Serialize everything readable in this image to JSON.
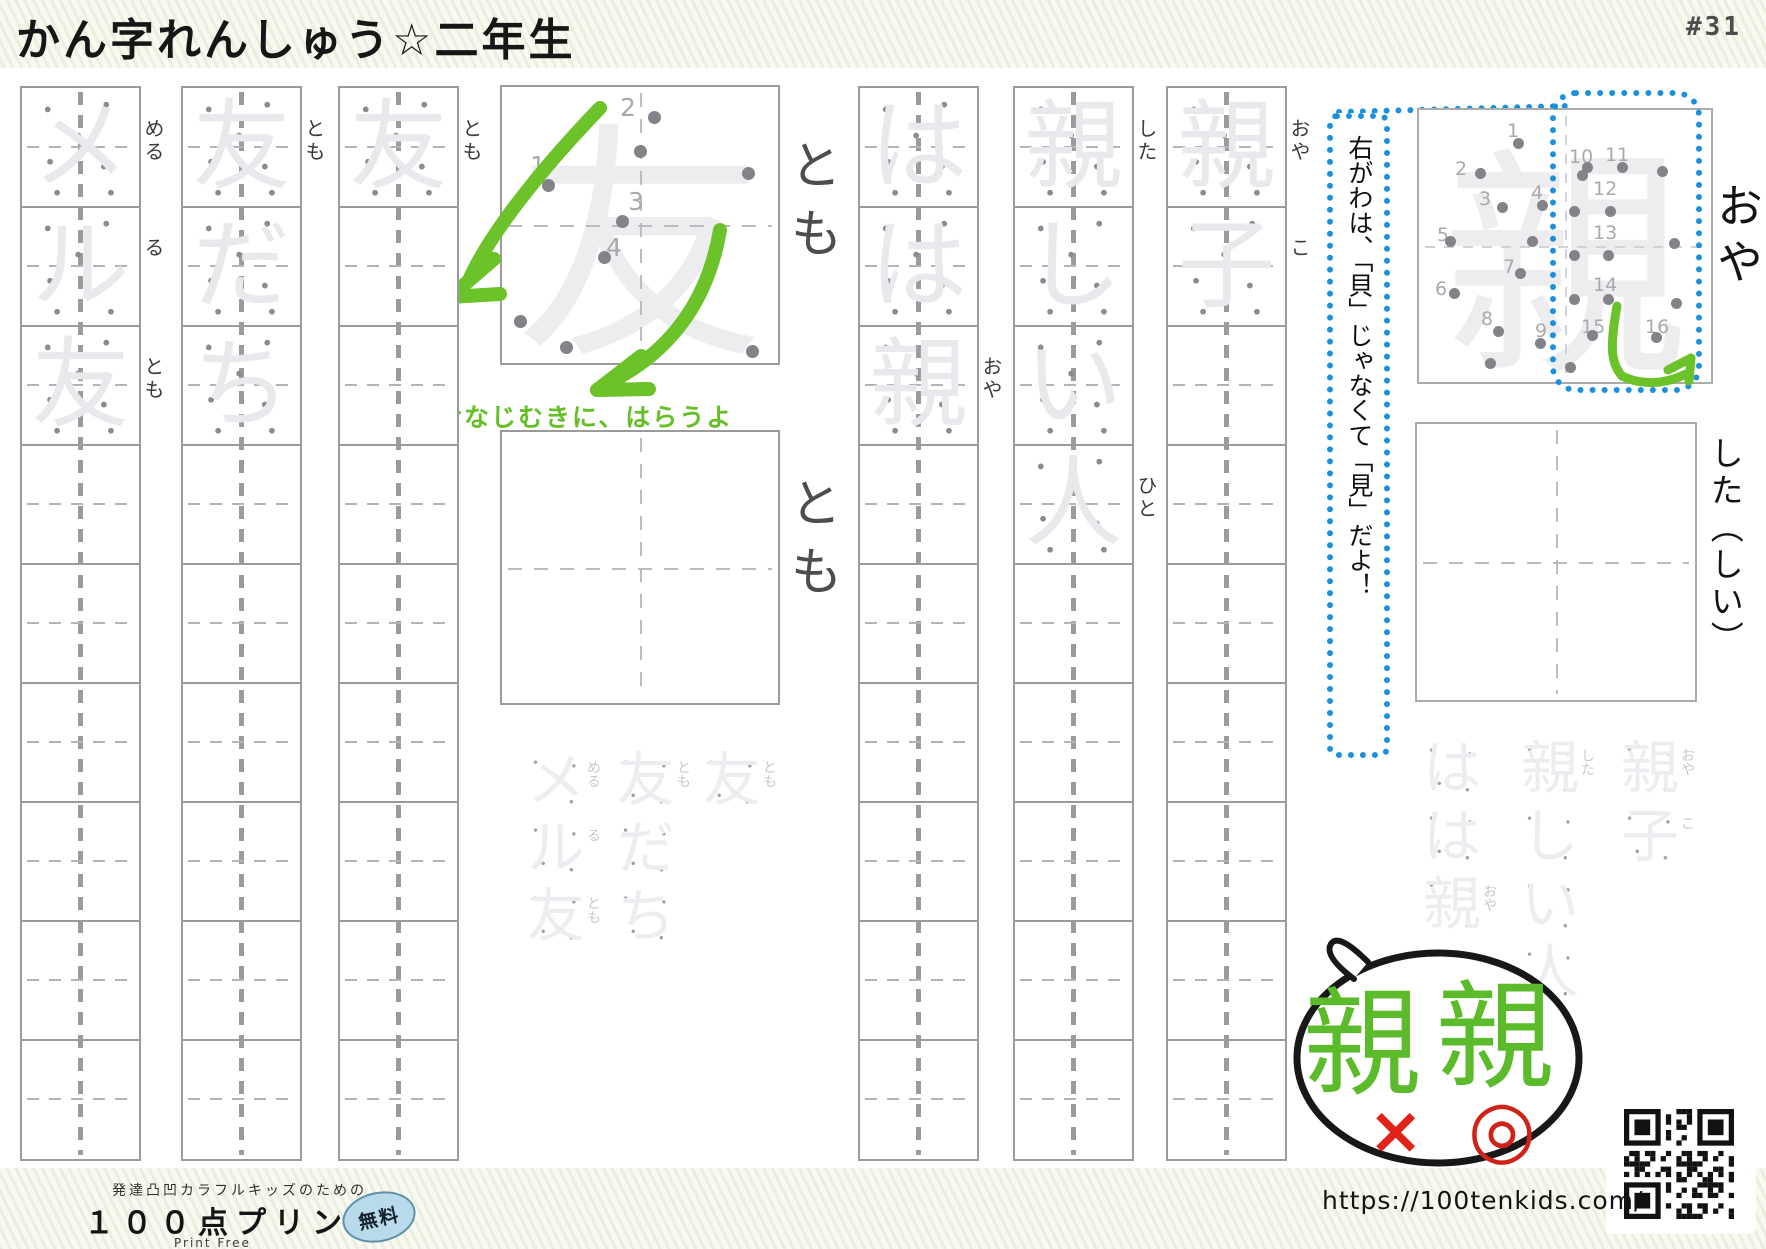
{
  "page": {
    "title": "かん字れんしゅう☆二年生",
    "number": "#31"
  },
  "colors": {
    "accent_green": "#6cc229",
    "accent_blue": "#1b90dd",
    "accent_red": "#e0231a",
    "trace_gray": "#e9e9ed"
  },
  "columns": [
    {
      "id": "meru-tomo",
      "cells": [
        {
          "trace": "メ",
          "furi": "める"
        },
        {
          "trace": "ル",
          "furi": "る"
        },
        {
          "trace": "友",
          "furi": "とも"
        },
        {},
        {},
        {},
        {},
        {},
        {}
      ]
    },
    {
      "id": "tomodachi",
      "cells": [
        {
          "trace": "友",
          "furi": "とも"
        },
        {
          "trace": "だ"
        },
        {
          "trace": "ち"
        },
        {},
        {},
        {},
        {},
        {},
        {}
      ]
    },
    {
      "id": "tomo",
      "cells": [
        {
          "trace": "友",
          "furi": "とも"
        },
        {},
        {},
        {},
        {},
        {},
        {},
        {},
        {}
      ]
    },
    {
      "id": "haha-oya",
      "cells": [
        {
          "trace": "は"
        },
        {
          "trace": "は"
        },
        {
          "trace": "親",
          "furi": "おや"
        },
        {},
        {},
        {},
        {},
        {},
        {}
      ]
    },
    {
      "id": "shitashii-hito",
      "cells": [
        {
          "trace": "親",
          "furi": "した"
        },
        {
          "trace": "し"
        },
        {
          "trace": "い"
        },
        {
          "trace": "人",
          "furi": "ひと"
        },
        {},
        {},
        {},
        {},
        {}
      ]
    },
    {
      "id": "oyako",
      "cells": [
        {
          "trace": "親",
          "furi": "おや"
        },
        {
          "trace": "子",
          "furi": "こ"
        },
        {},
        {},
        {},
        {},
        {},
        {},
        {}
      ]
    }
  ],
  "tomo_box": {
    "char": "友",
    "furigana": "とも",
    "caption": "おなじむきに、はらうよ",
    "numbers": [
      {
        "t": "1",
        "x": 28,
        "y": 66
      },
      {
        "t": "2",
        "x": 118,
        "y": 8
      },
      {
        "t": "3",
        "x": 126,
        "y": 102
      },
      {
        "t": "4",
        "x": 104,
        "y": 148
      }
    ],
    "dots": [
      [
        40,
        92
      ],
      [
        146,
        24
      ],
      [
        240,
        80
      ],
      [
        114,
        128
      ],
      [
        96,
        164
      ],
      [
        12,
        228
      ],
      [
        58,
        254
      ],
      [
        244,
        258
      ],
      [
        132,
        58
      ]
    ]
  },
  "practice_box_furigana": "とも",
  "annotation": {
    "text": "右がわは、「貝」じゃなくて「見」だよ！"
  },
  "oya_box": {
    "char": "親",
    "furigana": "おや",
    "numbers": [
      {
        "t": "1",
        "x": 88,
        "y": 12
      },
      {
        "t": "2",
        "x": 36,
        "y": 50
      },
      {
        "t": "3",
        "x": 60,
        "y": 80
      },
      {
        "t": "4",
        "x": 112,
        "y": 74
      },
      {
        "t": "5",
        "x": 18,
        "y": 116
      },
      {
        "t": "6",
        "x": 16,
        "y": 170
      },
      {
        "t": "7",
        "x": 84,
        "y": 148
      },
      {
        "t": "8",
        "x": 62,
        "y": 200
      },
      {
        "t": "9",
        "x": 116,
        "y": 212
      },
      {
        "t": "10",
        "x": 150,
        "y": 38
      },
      {
        "t": "11",
        "x": 186,
        "y": 36
      },
      {
        "t": "12",
        "x": 174,
        "y": 70
      },
      {
        "t": "13",
        "x": 174,
        "y": 114
      },
      {
        "t": "14",
        "x": 174,
        "y": 166
      },
      {
        "t": "15",
        "x": 162,
        "y": 208
      },
      {
        "t": "16",
        "x": 226,
        "y": 208
      }
    ],
    "dots": [
      [
        94,
        28
      ],
      [
        56,
        58
      ],
      [
        78,
        92
      ],
      [
        118,
        90
      ],
      [
        158,
        60
      ],
      [
        26,
        126
      ],
      [
        108,
        126
      ],
      [
        96,
        158
      ],
      [
        30,
        178
      ],
      [
        74,
        216
      ],
      [
        116,
        228
      ],
      [
        66,
        248
      ],
      [
        146,
        252
      ],
      [
        163,
        52
      ],
      [
        198,
        52
      ],
      [
        150,
        96
      ],
      [
        186,
        96
      ],
      [
        150,
        140
      ],
      [
        184,
        140
      ],
      [
        150,
        184
      ],
      [
        184,
        184
      ],
      [
        168,
        220
      ],
      [
        232,
        222
      ],
      [
        252,
        188
      ],
      [
        250,
        128
      ],
      [
        238,
        56
      ]
    ]
  },
  "side": {
    "oya": "おや",
    "shita": "した（しい）"
  },
  "ghost_left": {
    "cols": [
      {
        "chars": [
          {
            "t": "メ",
            "furi": "める"
          },
          {
            "t": "ル",
            "furi": "る"
          },
          {
            "t": "友",
            "furi": "とも"
          }
        ]
      },
      {
        "chars": [
          {
            "t": "友",
            "furi": "とも"
          },
          {
            "t": "だ"
          },
          {
            "t": "ち"
          }
        ]
      },
      {
        "chars": [
          {
            "t": "友",
            "furi": "とも"
          }
        ]
      }
    ]
  },
  "ghost_right": {
    "cols": [
      {
        "chars": [
          {
            "t": "は"
          },
          {
            "t": "は"
          },
          {
            "t": "親",
            "furi": "おや"
          }
        ]
      },
      {
        "chars": [
          {
            "t": "親",
            "furi": "した"
          },
          {
            "t": "し"
          },
          {
            "t": "い"
          },
          {
            "t": "人"
          }
        ]
      },
      {
        "chars": [
          {
            "t": "親",
            "furi": "おや"
          },
          {
            "t": "子",
            "furi": "こ"
          }
        ]
      }
    ]
  },
  "bubble": {
    "wrong_char": "親",
    "correct_char": "親",
    "wrong_mark": "×",
    "correct_mark": "◎"
  },
  "link": {
    "url": "https://100tenkids.com/"
  },
  "footer": {
    "tagline": "発達凸凹カラフルキッズのための",
    "brand": "１００点プリント",
    "badge": "無料",
    "subtitle": "Print Free"
  }
}
